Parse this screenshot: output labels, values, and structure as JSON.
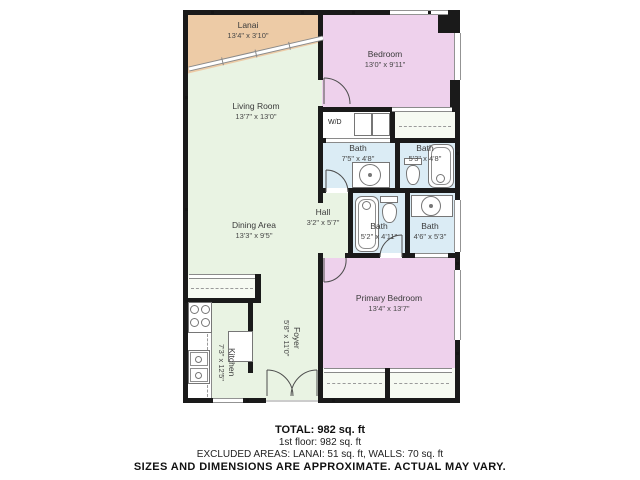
{
  "floor_plan": {
    "colors": {
      "lanai": "#edcba6",
      "bedroom": "#eed1ec",
      "living": "#e9f3e3",
      "bath": "#dbecf5",
      "closet": "#f6faf2",
      "wall": "#1a1a1a"
    },
    "rooms": {
      "lanai": {
        "label": "Lanai",
        "dims": "13'4\" x 3'10\""
      },
      "bedroom": {
        "label": "Bedroom",
        "dims": "13'0\" x 9'11\""
      },
      "living_room": {
        "label": "Living Room",
        "dims": "13'7\" x 13'0\""
      },
      "dining_area": {
        "label": "Dining Area",
        "dims": "13'3\" x 9'5\""
      },
      "hall": {
        "label": "Hall",
        "dims": "3'2\" x 5'7\""
      },
      "bath_a": {
        "label": "Bath",
        "dims": "7'5\" x 4'8\""
      },
      "bath_b": {
        "label": "Bath",
        "dims": "5'3\" x 4'8\""
      },
      "bath_c": {
        "label": "Bath",
        "dims": "5'2\" x 4'11\""
      },
      "bath_d": {
        "label": "Bath",
        "dims": "4'6\" x 5'3\""
      },
      "primary_bedroom": {
        "label": "Primary Bedroom",
        "dims": "13'4\" x 13'7\""
      },
      "foyer": {
        "label": "Foyer",
        "dims": "5'8\" x 11'0\""
      },
      "kitchen": {
        "label": "Kitchen",
        "dims": "7'3\" x 12'5\""
      },
      "laundry": {
        "label": "W/D"
      }
    },
    "summary": {
      "total": "TOTAL: 982 sq. ft",
      "floor": "1st floor: 982 sq. ft",
      "excluded": "EXCLUDED AREAS: LANAI: 51 sq. ft, WALLS: 70 sq. ft",
      "disclaimer": "SIZES AND DIMENSIONS ARE APPROXIMATE. ACTUAL MAY VARY."
    }
  }
}
